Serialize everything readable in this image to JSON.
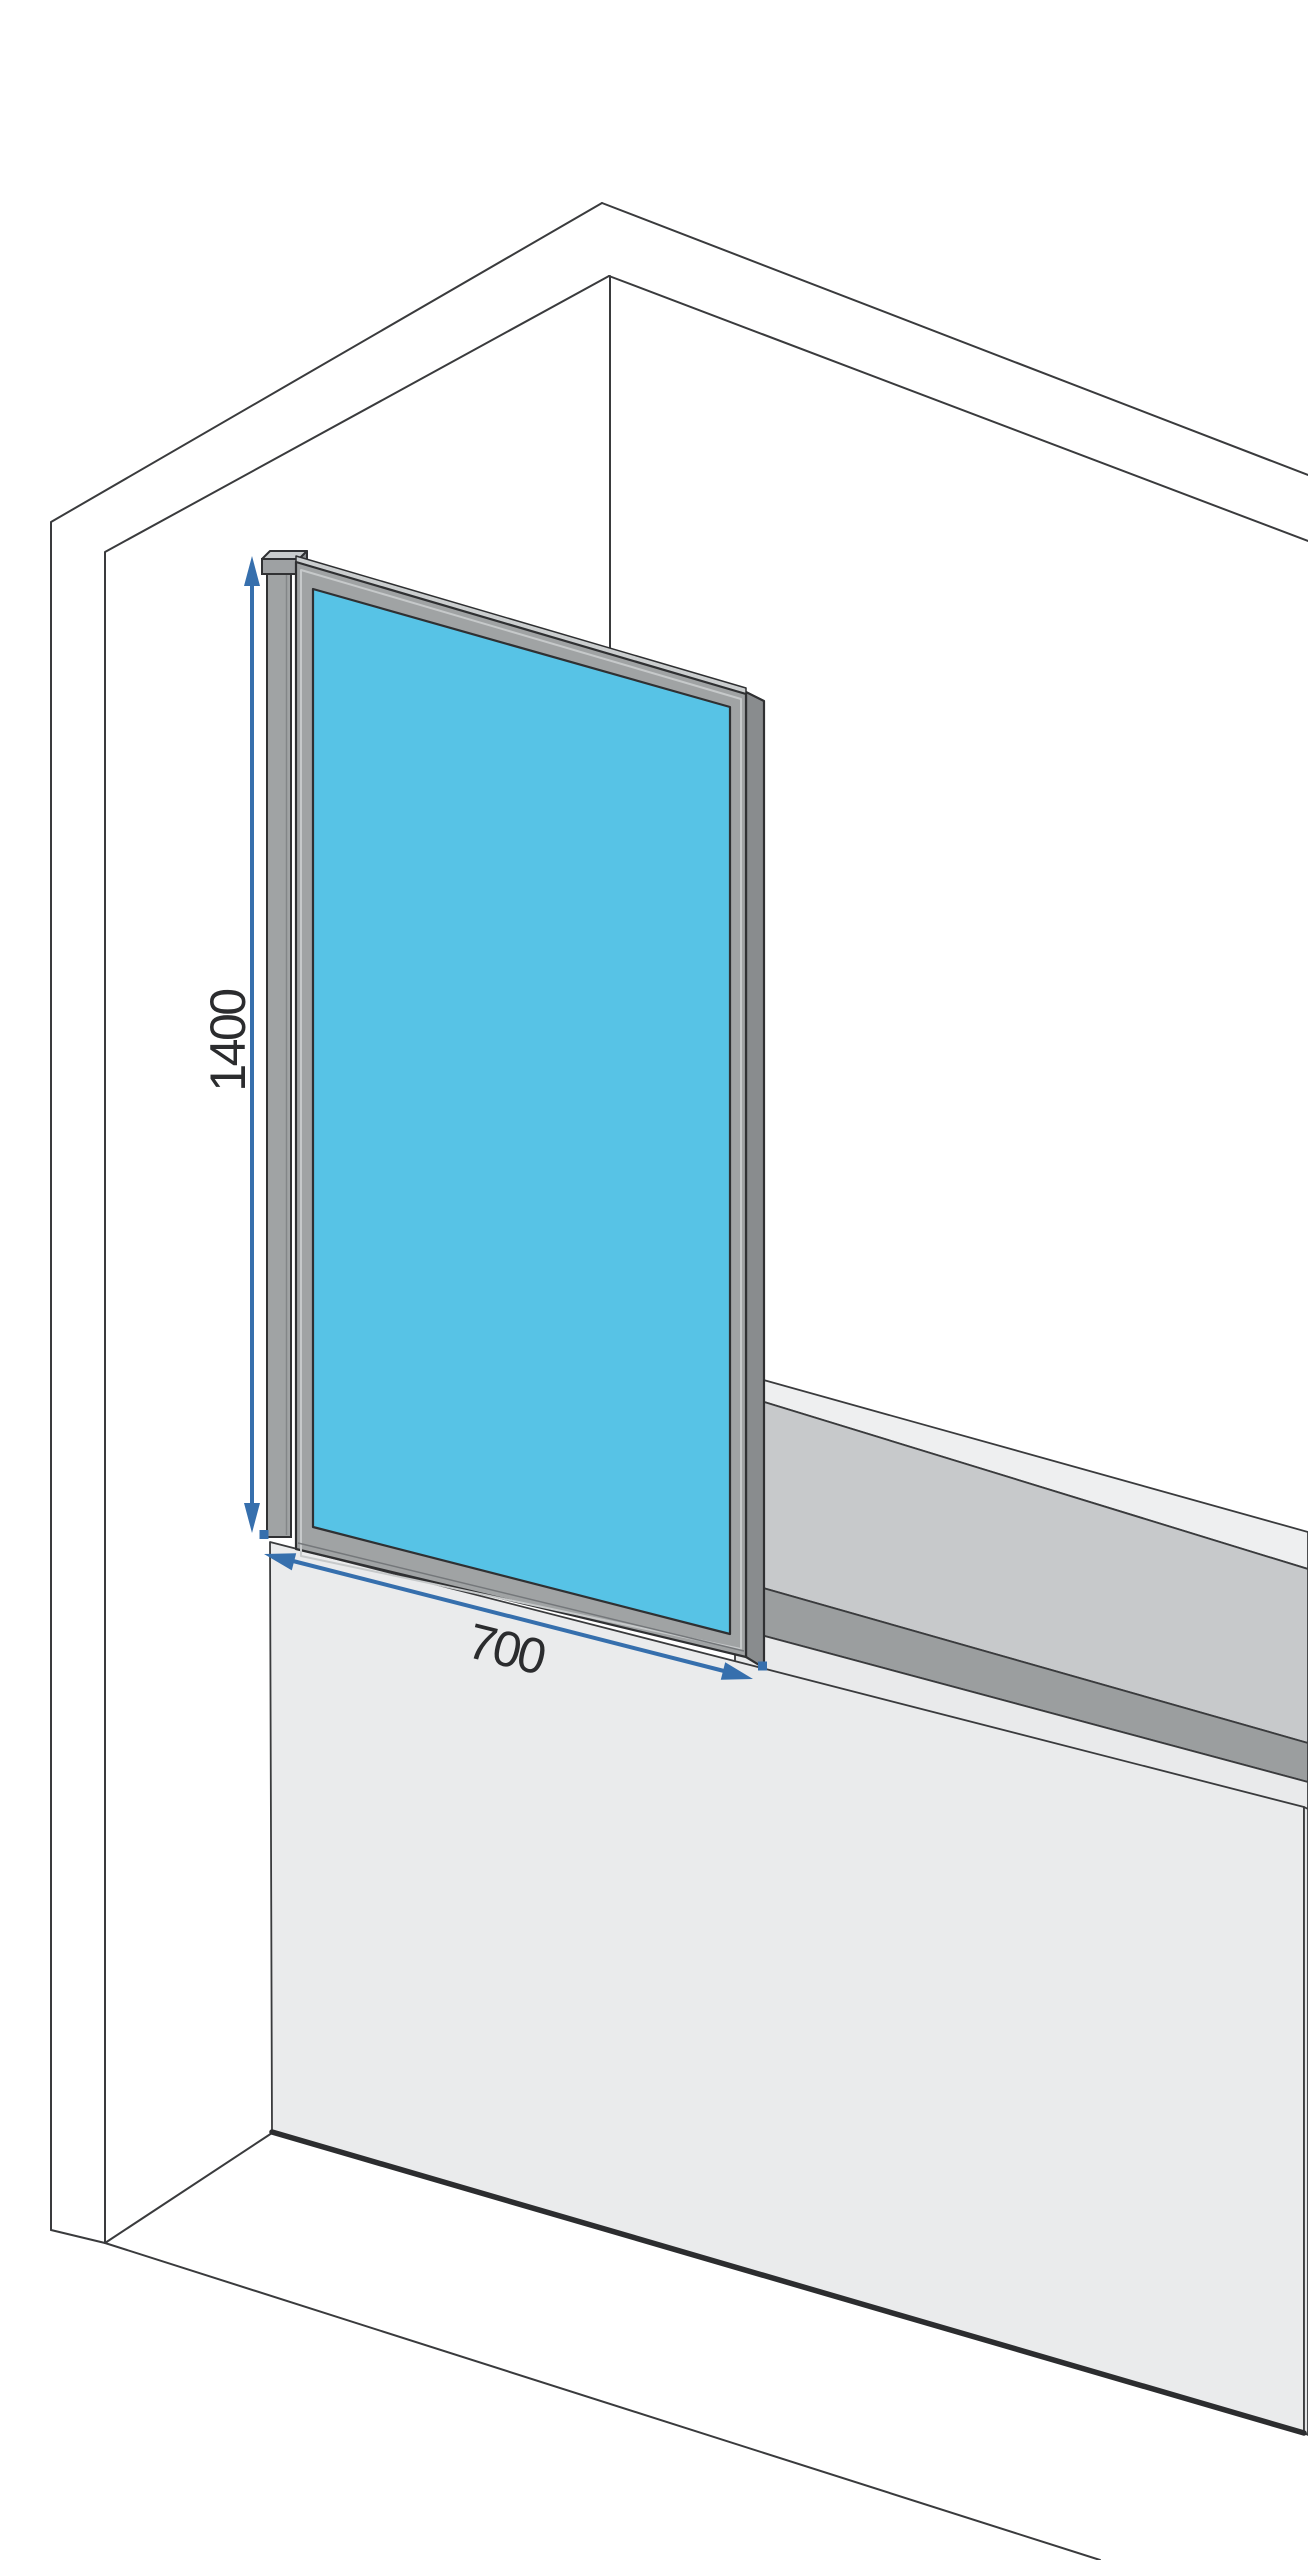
{
  "dimensions": {
    "height": {
      "label": "1400"
    },
    "width": {
      "label": "700"
    }
  },
  "colors": {
    "glass": "#57C3E6",
    "dimension": "#366FAD",
    "frame": "#A0A3A4",
    "frame_side": "#898C8E",
    "frame_highlight": "#CBCECF",
    "outline": "#3A3B3D",
    "tub_front": "#EAEBEC",
    "tub_rim_far": "#EEEFF0",
    "tub_rim_near": "#E9EAEB",
    "tub_inner_wall": "#C7C9CB",
    "tub_inner_shadow": "#9B9E9F"
  }
}
